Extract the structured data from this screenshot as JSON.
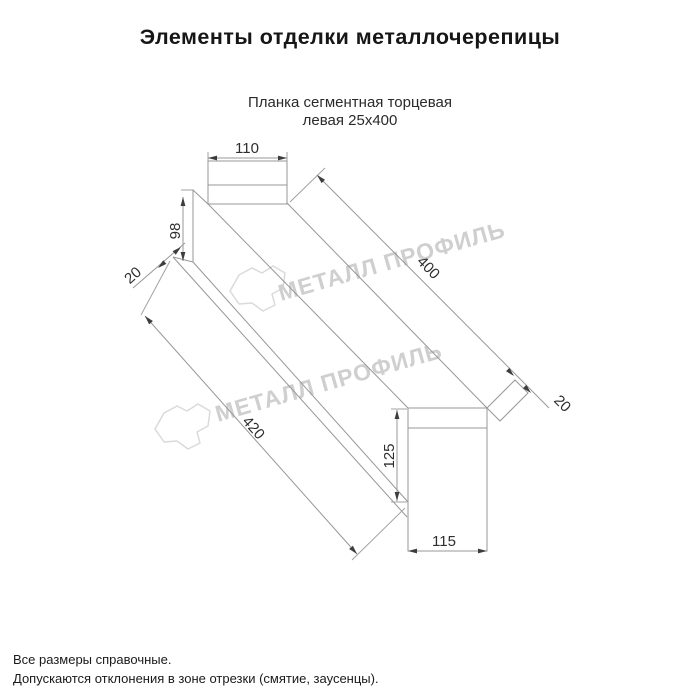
{
  "page": {
    "title": "Элементы отделки металлочерепицы",
    "subtitle": [
      "Планка сегментная торцевая",
      "левая 25х400"
    ]
  },
  "drawing": {
    "dims": {
      "top_flange_width": {
        "label": "110"
      },
      "left_face_height": {
        "label": "98"
      },
      "left_hem": {
        "label": "20"
      },
      "length": {
        "label": "400"
      },
      "end_fold": {
        "label": "20"
      },
      "bottom_length": {
        "label": "420"
      },
      "right_face_height": {
        "label": "125"
      },
      "end_cap_width": {
        "label": "115"
      }
    }
  },
  "watermark": {
    "text": "МЕТАЛЛ ПРОФИЛЬ",
    "color": "#cfcfcf"
  },
  "footer": {
    "notes": [
      "Все размеры справочные.",
      "Допускаются отклонения в зоне отрезки (смятие, заусенцы)."
    ]
  }
}
